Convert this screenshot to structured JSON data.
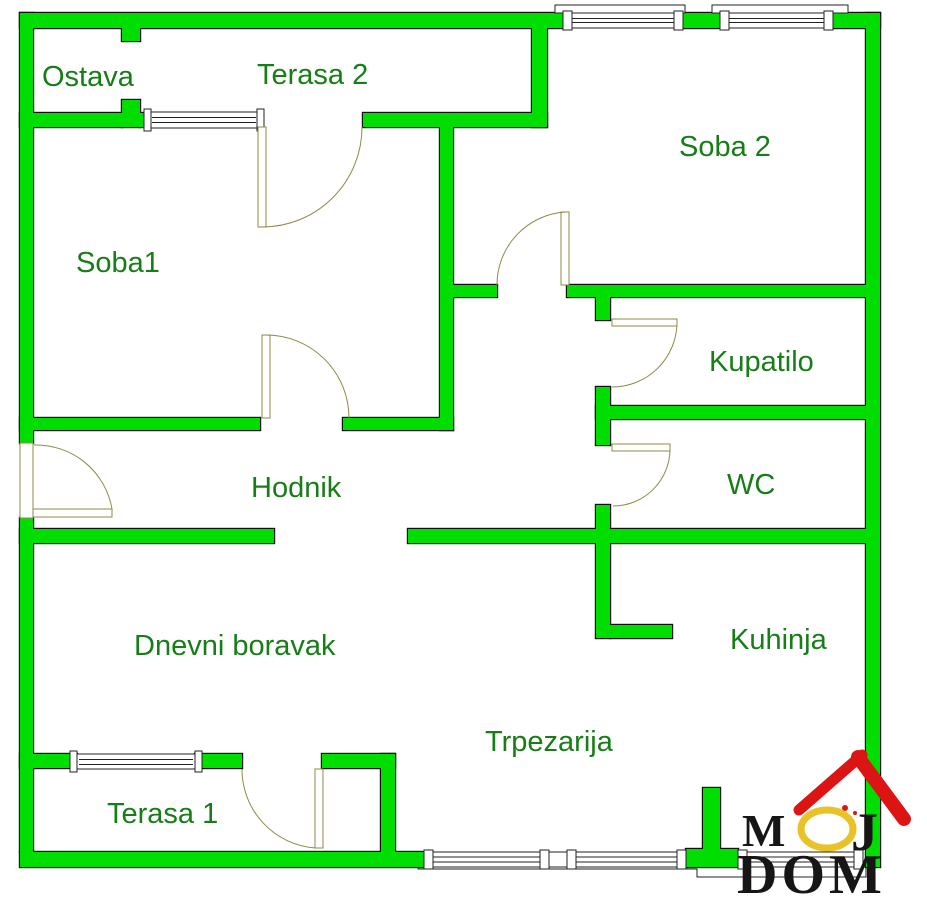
{
  "plan_title": "apartment-floor-plan",
  "rooms": [
    {
      "label": "Ostava"
    },
    {
      "label": "Terasa 2"
    },
    {
      "label": "Soba 2"
    },
    {
      "label": "Soba1"
    },
    {
      "label": "Kupatilo"
    },
    {
      "label": "Hodnik"
    },
    {
      "label": "WC"
    },
    {
      "label": "Dnevni boravak"
    },
    {
      "label": "Kuhinja"
    },
    {
      "label": "Trpezarija"
    },
    {
      "label": "Terasa 1"
    }
  ],
  "logo": {
    "m": "M",
    "o": "O",
    "j": "J",
    "word2": "DOM"
  },
  "colors": {
    "background": "#ffffff",
    "wall": "#00dd00",
    "wall_outline": "#111111",
    "label_text": "#177d17",
    "door_line": "#8f8a45",
    "window_line": "#222222",
    "logo_red": "#dd1414",
    "logo_gold": "#e8c227",
    "logo_text": "#161616"
  }
}
